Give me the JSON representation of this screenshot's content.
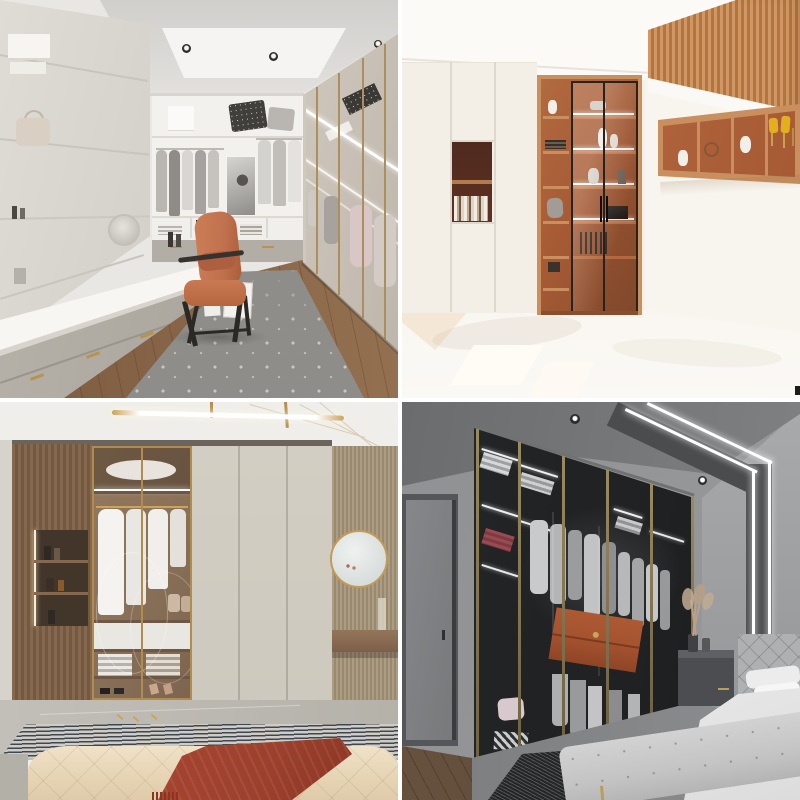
{
  "page": {
    "title": "Wardrobe interiors photo collage",
    "grid": {
      "rows": 2,
      "cols": 2,
      "gap_px": 4
    }
  },
  "palette": {
    "page": {
      "gutter": "#ffffff"
    },
    "p1": {
      "wall": "#e9e7e3",
      "ceiling": "#d0cfcc",
      "ceilinglight": "#f5f4f2",
      "cabinet": "#dfdcd5",
      "drawer": "#b2aea5",
      "counter": "#f8f6f2",
      "wood": "#7d5b41",
      "rug": "#8e8d89",
      "rugdot": "#c8c7c3",
      "chair": "#c0714e",
      "chairframe": "#2b2926",
      "gold": "#b9924f",
      "glass": "#d8d2c9",
      "backwall": "#f3f1ee"
    },
    "p2": {
      "wall": "#f5f1e9",
      "ceiling": "#fbfaf7",
      "floor": "#f6f2eb",
      "slat": "#d09764",
      "slatdark": "#b1763f",
      "wood": "#c98f5e",
      "back": "#a55a34",
      "niche": "#5f3123",
      "frame": "#262220",
      "yellow": "#e2b01f",
      "white": "#f2efe9"
    },
    "p3": {
      "ceiling": "#efeeea",
      "woodpanel": "#84684f",
      "interior": "#8a7158",
      "gold": "#b08c4f",
      "door": "#cdc9be",
      "slatwall": "#ab9c84",
      "tile": "#b5b2aa",
      "rugnavy": "#3f4654",
      "ruglight": "#cfccc4",
      "bed": "#e8d7b8",
      "throw": "#9c412e",
      "mirror": "#c49a58",
      "lamp": "#caa45c"
    },
    "p4": {
      "wall": "#8f9193",
      "wallbright": "#a8aaac",
      "ceiling": "#6a6c6e",
      "dark": "#1f2123",
      "bronze": "#9a8a60",
      "led": "#ffffff",
      "clothes": "#b7b8ba",
      "orange": "#a5532f",
      "bed": "#f0f0f0",
      "bench": "#c4c4c4",
      "stand": "#4b4d51",
      "pampas": "#b9a086",
      "rug": "#232527",
      "floorwood": "#66503e"
    }
  },
  "photos": [
    {
      "id": "walk-in-closet",
      "alt": "Walk-in closet with cream shelving, grey drawers with gold handles, terracotta desk chair, glass wardrobe wall and patterned grey rug"
    },
    {
      "id": "orange-bookshelf-room",
      "alt": "Bright white room with tall wood bookshelf, glass display doors, orange shelf niches, wood slat soffit and wall-hung display shelf"
    },
    {
      "id": "bedroom-wardrobe",
      "alt": "Bedroom wardrobe with wood panel, gold framed glass doors showing white clothes, plain greige doors, round gold mirror, striped rug and tufted cream bed with rust throw"
    },
    {
      "id": "dark-bedroom-closet",
      "alt": "Dark grey bedroom with glass door wardrobe lit by LED strips, orange drawer unit inside, angled LED ceiling lines, grey nightstand with pampas and white bed"
    }
  ]
}
